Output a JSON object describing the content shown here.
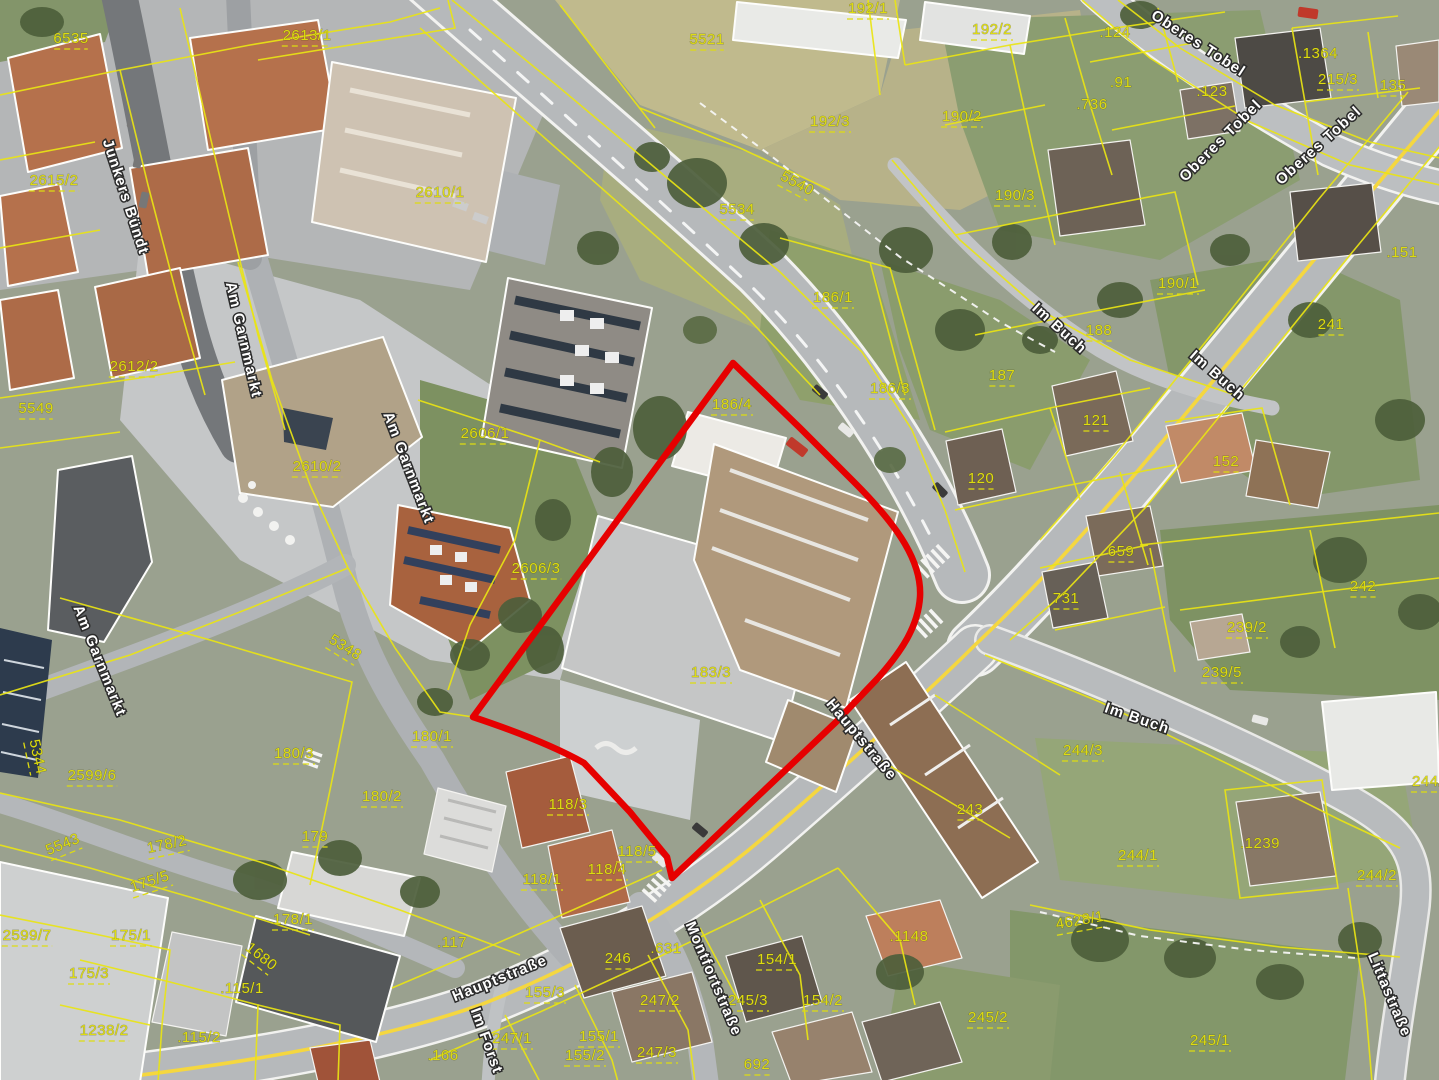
{
  "map": {
    "type": "aerial-cadastral-map",
    "colors": {
      "parcel_line": "#e9e414",
      "parcel_text": "#dedc10",
      "street_text": "#ffffff",
      "street_halo": "#2b2b2b",
      "red_boundary": "#e60000",
      "road_fill": "#b6b9bb",
      "road_casing": "#f2f2f0",
      "center_line": "#f5d73f"
    },
    "red_boundary": {
      "path": "M473,717 L733,363 L800,428 L854,482 C900,528 922,563 920,597 C918,627 901,652 878,678 L836,722 L672,878 L667,857 L630,812 L584,763 Q545,741 473,717 Z",
      "stroke_width": 6.5
    },
    "parcel_labels": [
      {
        "t": "6535",
        "x": 71,
        "y": 39,
        "r": 0
      },
      {
        "t": "2615/2",
        "x": 54,
        "y": 181,
        "r": 0
      },
      {
        "t": "2613/1",
        "x": 307,
        "y": 36,
        "r": 0
      },
      {
        "t": "2610/1",
        "x": 440,
        "y": 193,
        "r": 0
      },
      {
        "t": "2610/2",
        "x": 317,
        "y": 467,
        "r": 0
      },
      {
        "t": "2612/2",
        "x": 134,
        "y": 367,
        "r": 0
      },
      {
        "t": "5549",
        "x": 36,
        "y": 409,
        "r": 0
      },
      {
        "t": "5344",
        "x": 37,
        "y": 757,
        "r": 78
      },
      {
        "t": "2599/6",
        "x": 92,
        "y": 776,
        "r": 0
      },
      {
        "t": "2599/7",
        "x": 27,
        "y": 936,
        "r": 0
      },
      {
        "t": "5543",
        "x": 63,
        "y": 845,
        "r": -22
      },
      {
        "t": "5348",
        "x": 345,
        "y": 648,
        "r": 32
      },
      {
        "t": "175/5",
        "x": 150,
        "y": 882,
        "r": -18
      },
      {
        "t": "178/2",
        "x": 167,
        "y": 845,
        "r": -12
      },
      {
        "t": "175/1",
        "x": 131,
        "y": 936,
        "r": 0
      },
      {
        "t": "175/3",
        "x": 89,
        "y": 974,
        "r": 0
      },
      {
        "t": "1238/2",
        "x": 104,
        "y": 1031,
        "r": 0
      },
      {
        "t": ".115/2",
        "x": 199,
        "y": 1038,
        "r": 0,
        "dot": true
      },
      {
        "t": ".115/1",
        "x": 242,
        "y": 989,
        "r": 0,
        "dot": true
      },
      {
        "t": "178/1",
        "x": 293,
        "y": 920,
        "r": 0
      },
      {
        "t": "180/3",
        "x": 294,
        "y": 754,
        "r": 0
      },
      {
        "t": "180/1",
        "x": 432,
        "y": 737,
        "r": 0
      },
      {
        "t": "180/2",
        "x": 382,
        "y": 797,
        "r": 0
      },
      {
        "t": "179",
        "x": 315,
        "y": 837,
        "r": 0
      },
      {
        "t": "1680",
        "x": 261,
        "y": 957,
        "r": 38
      },
      {
        "t": ".117",
        "x": 452,
        "y": 943,
        "r": 0,
        "dot": true
      },
      {
        "t": ".166",
        "x": 443,
        "y": 1056,
        "r": 0,
        "dot": true
      },
      {
        "t": "247/1",
        "x": 512,
        "y": 1039,
        "r": 0
      },
      {
        "t": "155/3",
        "x": 545,
        "y": 993,
        "r": 0
      },
      {
        "t": "155/1",
        "x": 599,
        "y": 1037,
        "r": 0
      },
      {
        "t": "155/2",
        "x": 585,
        "y": 1056,
        "r": 0
      },
      {
        "t": "247/3",
        "x": 657,
        "y": 1053,
        "r": 0
      },
      {
        "t": "247/2",
        "x": 660,
        "y": 1001,
        "r": 0
      },
      {
        "t": ".631",
        "x": 666,
        "y": 949,
        "r": 0,
        "dot": true
      },
      {
        "t": "246",
        "x": 618,
        "y": 959,
        "r": 0
      },
      {
        "t": "692",
        "x": 757,
        "y": 1065,
        "r": 0
      },
      {
        "t": "245/3",
        "x": 748,
        "y": 1001,
        "r": 0
      },
      {
        "t": "154/2",
        "x": 823,
        "y": 1001,
        "r": 0
      },
      {
        "t": "154/1",
        "x": 777,
        "y": 960,
        "r": 0
      },
      {
        "t": ".1148",
        "x": 909,
        "y": 937,
        "r": 0,
        "dot": true
      },
      {
        "t": "245/2",
        "x": 988,
        "y": 1018,
        "r": 0
      },
      {
        "t": "243",
        "x": 970,
        "y": 810,
        "r": 0
      },
      {
        "t": "245/1",
        "x": 1210,
        "y": 1041,
        "r": 0
      },
      {
        "t": "244/1",
        "x": 1138,
        "y": 856,
        "r": 0
      },
      {
        "t": "244/2",
        "x": 1377,
        "y": 876,
        "r": 0
      },
      {
        "t": ".1239",
        "x": 1260,
        "y": 844,
        "r": 0,
        "dot": true
      },
      {
        "t": "4628/1",
        "x": 1080,
        "y": 921,
        "r": -10
      },
      {
        "t": "244/3",
        "x": 1083,
        "y": 751,
        "r": 0
      },
      {
        "t": "244/7",
        "x": 1432,
        "y": 782,
        "r": 0
      },
      {
        "t": "118/1",
        "x": 542,
        "y": 880,
        "r": 0
      },
      {
        "t": "118/3",
        "x": 568,
        "y": 805,
        "r": 0
      },
      {
        "t": "118/4",
        "x": 607,
        "y": 870,
        "r": 0
      },
      {
        "t": "118/5",
        "x": 637,
        "y": 852,
        "r": 0
      },
      {
        "t": "2606/1",
        "x": 485,
        "y": 434,
        "r": 0
      },
      {
        "t": "2606/3",
        "x": 536,
        "y": 569,
        "r": 0
      },
      {
        "t": "183/3",
        "x": 711,
        "y": 673,
        "r": 0
      },
      {
        "t": "186/4",
        "x": 732,
        "y": 405,
        "r": 0
      },
      {
        "t": "5521",
        "x": 707,
        "y": 40,
        "r": 0
      },
      {
        "t": "5534",
        "x": 737,
        "y": 210,
        "r": 0
      },
      {
        "t": "5540",
        "x": 797,
        "y": 184,
        "r": 28
      },
      {
        "t": "192/1",
        "x": 868,
        "y": 9,
        "r": 0
      },
      {
        "t": "192/3",
        "x": 830,
        "y": 122,
        "r": 0
      },
      {
        "t": "192/2",
        "x": 992,
        "y": 30,
        "r": 0
      },
      {
        "t": "186/1",
        "x": 833,
        "y": 298,
        "r": 0
      },
      {
        "t": "186/3",
        "x": 890,
        "y": 389,
        "r": 0
      },
      {
        "t": "187",
        "x": 1002,
        "y": 376,
        "r": 0
      },
      {
        "t": "188",
        "x": 1099,
        "y": 331,
        "r": 0
      },
      {
        "t": "190/2",
        "x": 962,
        "y": 117,
        "r": 0
      },
      {
        "t": "190/3",
        "x": 1015,
        "y": 196,
        "r": 0
      },
      {
        "t": "190/1",
        "x": 1178,
        "y": 284,
        "r": 0
      },
      {
        "t": ".124",
        "x": 1115,
        "y": 33,
        "r": 0,
        "dot": true
      },
      {
        "t": ".91",
        "x": 1121,
        "y": 83,
        "r": 0,
        "dot": true
      },
      {
        "t": ".736",
        "x": 1092,
        "y": 105,
        "r": 0,
        "dot": true
      },
      {
        "t": ".123",
        "x": 1212,
        "y": 92,
        "r": 0,
        "dot": true
      },
      {
        "t": ".1364",
        "x": 1318,
        "y": 54,
        "r": 0,
        "dot": true
      },
      {
        "t": "215/3",
        "x": 1338,
        "y": 80,
        "r": 0
      },
      {
        "t": "135",
        "x": 1393,
        "y": 86,
        "r": 0
      },
      {
        "t": ".151",
        "x": 1402,
        "y": 253,
        "r": 0,
        "dot": true
      },
      {
        "t": "241",
        "x": 1331,
        "y": 325,
        "r": 0
      },
      {
        "t": "121",
        "x": 1096,
        "y": 421,
        "r": 0
      },
      {
        "t": "120",
        "x": 981,
        "y": 479,
        "r": 0
      },
      {
        "t": "152",
        "x": 1226,
        "y": 462,
        "r": 0
      },
      {
        "t": "659",
        "x": 1121,
        "y": 552,
        "r": 0
      },
      {
        "t": "731",
        "x": 1066,
        "y": 599,
        "r": 0
      },
      {
        "t": "242",
        "x": 1363,
        "y": 587,
        "r": 0
      },
      {
        "t": "239/2",
        "x": 1247,
        "y": 628,
        "r": 0
      },
      {
        "t": "239/5",
        "x": 1222,
        "y": 673,
        "r": 0
      }
    ],
    "street_labels": [
      {
        "t": "Junkers Bündt",
        "x": 125,
        "y": 197,
        "r": 72
      },
      {
        "t": "Am Garnmarkt",
        "x": 243,
        "y": 340,
        "r": 77
      },
      {
        "t": "Am Garnmarkt",
        "x": 408,
        "y": 468,
        "r": 69
      },
      {
        "t": "Am Garnmarkt",
        "x": 99,
        "y": 661,
        "r": 68
      },
      {
        "t": "Oberes Tobel",
        "x": 1198,
        "y": 44,
        "r": 33
      },
      {
        "t": "Oberes Tobel",
        "x": 1221,
        "y": 141,
        "r": -45
      },
      {
        "t": "Oberes Tobel",
        "x": 1319,
        "y": 146,
        "r": -42
      },
      {
        "t": "Im Buch",
        "x": 1059,
        "y": 329,
        "r": 42
      },
      {
        "t": "Im Buch",
        "x": 1217,
        "y": 376,
        "r": 41
      },
      {
        "t": "Im Buch",
        "x": 1137,
        "y": 719,
        "r": 19
      },
      {
        "t": "Hauptstraße",
        "x": 861,
        "y": 740,
        "r": 50
      },
      {
        "t": "Hauptstraße",
        "x": 500,
        "y": 979,
        "r": -22
      },
      {
        "t": "Im Forst",
        "x": 486,
        "y": 1041,
        "r": 70
      },
      {
        "t": "Montfortstraße",
        "x": 713,
        "y": 979,
        "r": 67
      },
      {
        "t": "Littastraße",
        "x": 1389,
        "y": 995,
        "r": 67
      }
    ]
  }
}
